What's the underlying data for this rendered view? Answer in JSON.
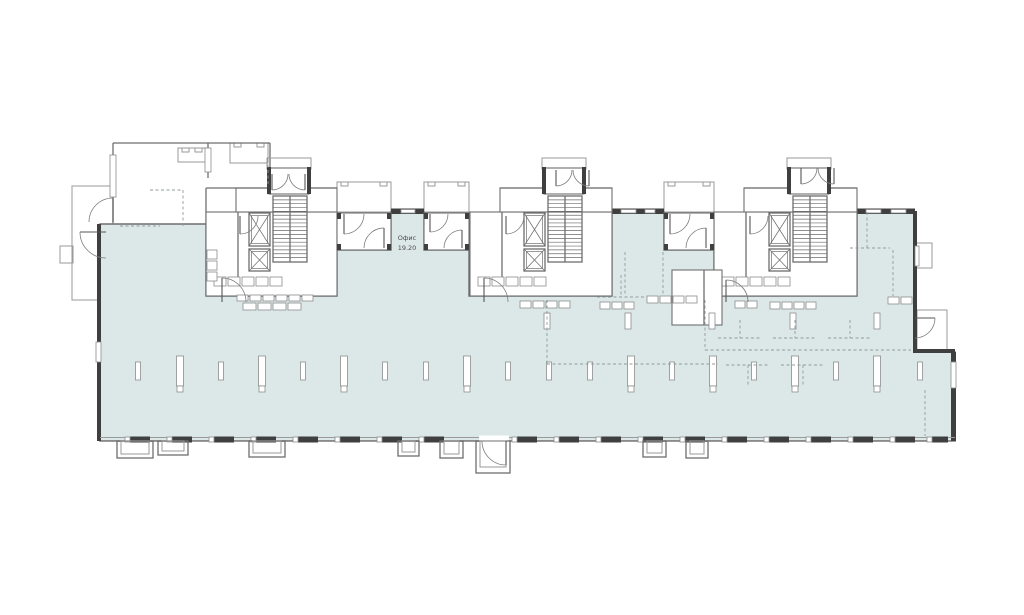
{
  "title": "floor-plan",
  "label": {
    "name": "Офис",
    "area": "19.20"
  },
  "colors": {
    "paper": "#ffffff",
    "space_fill": "#dce8e8",
    "wall_dark": "#3f3f3f",
    "line_medium": "#6e6e6e",
    "line_light": "#9a9a9a",
    "dashed": "#8f9b9b",
    "text": "#4c4c4c"
  },
  "plan": {
    "space_path": "M100,224 H206 V296 H337 V250 H391 V212 H424 V250 H469 V296 H612 V212 H664 V250 H714 V296 H857 V212 H915 V352 H955 V441 H100 Z",
    "label_pos": {
      "x": 407,
      "y1": 240,
      "y2": 250
    },
    "cores": [
      {
        "x": 206,
        "w": 131,
        "fixtures": true
      },
      {
        "x": 470,
        "w": 142,
        "fixtures": false
      },
      {
        "x": 714,
        "w": 143,
        "fixtures": false
      }
    ],
    "vestibules": [
      {
        "x": 337,
        "w": 54
      },
      {
        "x": 424,
        "w": 45
      },
      {
        "x": 664,
        "w": 50
      }
    ],
    "canopies": [
      {
        "x": 337,
        "y": 182,
        "w": 54,
        "h": 30
      },
      {
        "x": 424,
        "y": 182,
        "w": 45,
        "h": 30
      },
      {
        "x": 664,
        "y": 182,
        "w": 50,
        "h": 30
      },
      {
        "x": 230,
        "y": 143,
        "w": 38,
        "h": 20
      },
      {
        "x": 178,
        "y": 148,
        "w": 28,
        "h": 14
      }
    ],
    "exterior_rects": [
      {
        "x": 72,
        "y": 186,
        "w": 41,
        "h": 114
      },
      {
        "x": 60,
        "y": 246,
        "w": 13,
        "h": 17
      },
      {
        "x": 917,
        "y": 310,
        "w": 30,
        "h": 42
      },
      {
        "x": 915,
        "y": 243,
        "w": 17,
        "h": 25
      }
    ],
    "apartment_walls": [
      [
        113,
        143,
        270,
        143
      ],
      [
        113,
        143,
        113,
        223
      ],
      [
        270,
        143,
        270,
        188
      ],
      [
        206,
        188,
        206,
        223
      ],
      [
        206,
        188,
        236,
        188
      ],
      [
        208,
        143,
        208,
        178
      ]
    ],
    "apartment_windows": [
      {
        "x": 110,
        "y": 155,
        "w": 6,
        "h": 42
      },
      {
        "x": 205,
        "y": 148,
        "w": 6,
        "h": 24
      }
    ],
    "dark_walls": [
      {
        "x": 97,
        "y": 224,
        "w": 4,
        "h": 217
      },
      {
        "x": 913,
        "y": 211,
        "w": 4,
        "h": 141
      },
      {
        "x": 951,
        "y": 352,
        "w": 5,
        "h": 89
      },
      {
        "x": 913,
        "y": 349,
        "w": 42,
        "h": 4
      }
    ],
    "wall_window_breaks": [
      {
        "x": 96,
        "y": 342,
        "w": 5,
        "h": 20
      },
      {
        "x": 951,
        "y": 362,
        "w": 5,
        "h": 26
      },
      {
        "x": 915,
        "y": 246,
        "w": 4,
        "h": 20
      }
    ],
    "top_wall_segments": [
      {
        "x1": 391,
        "x2": 424,
        "windows": [
          [
            401,
            14
          ]
        ]
      },
      {
        "x1": 612,
        "x2": 664,
        "windows": [
          [
            621,
            15
          ],
          [
            645,
            10
          ]
        ]
      },
      {
        "x1": 857,
        "x2": 915,
        "windows": [
          [
            866,
            15
          ],
          [
            891,
            15
          ]
        ]
      }
    ],
    "bottom_wall": {
      "x1": 100,
      "x2": 955,
      "y": 437,
      "pier_w": 20,
      "piers": [
        130,
        172,
        214,
        256,
        298,
        340,
        382,
        424,
        517,
        559,
        601,
        643,
        685,
        727,
        769,
        811,
        853,
        895,
        932
      ],
      "door_gap": {
        "x": 479,
        "w": 30
      }
    },
    "wells": [
      {
        "x": 117,
        "w": 36,
        "h": 17
      },
      {
        "x": 158,
        "w": 30,
        "h": 14
      },
      {
        "x": 249,
        "w": 36,
        "h": 16
      },
      {
        "x": 398,
        "w": 21,
        "h": 15
      },
      {
        "x": 440,
        "w": 23,
        "h": 17
      },
      {
        "x": 643,
        "w": 23,
        "h": 16
      },
      {
        "x": 686,
        "w": 22,
        "h": 17
      }
    ],
    "entry_porch": {
      "x": 476,
      "y": 441,
      "w": 34,
      "h": 32
    },
    "columns": [
      {
        "x": 138,
        "t": "s"
      },
      {
        "x": 180,
        "t": "t"
      },
      {
        "x": 221,
        "t": "s"
      },
      {
        "x": 262,
        "t": "t"
      },
      {
        "x": 303,
        "t": "s"
      },
      {
        "x": 344,
        "t": "t"
      },
      {
        "x": 385,
        "t": "s"
      },
      {
        "x": 426,
        "t": "s"
      },
      {
        "x": 467,
        "t": "t"
      },
      {
        "x": 508,
        "t": "s"
      },
      {
        "x": 549,
        "t": "s"
      },
      {
        "x": 590,
        "t": "s"
      },
      {
        "x": 631,
        "t": "t"
      },
      {
        "x": 672,
        "t": "s"
      },
      {
        "x": 713,
        "t": "t"
      },
      {
        "x": 754,
        "t": "s"
      },
      {
        "x": 795,
        "t": "t"
      },
      {
        "x": 836,
        "t": "s"
      },
      {
        "x": 877,
        "t": "t"
      },
      {
        "x": 920,
        "t": "s"
      }
    ],
    "mid_columns": [
      {
        "x": 547
      },
      {
        "x": 628
      },
      {
        "x": 712
      },
      {
        "x": 793
      },
      {
        "x": 877
      }
    ],
    "slab_rows": [
      {
        "x": 237,
        "y": 295,
        "n": 6,
        "w": 11,
        "h": 6,
        "gap": 2
      },
      {
        "x": 243,
        "y": 303,
        "n": 4,
        "w": 13,
        "h": 7,
        "gap": 2
      },
      {
        "x": 520,
        "y": 301,
        "n": 4,
        "w": 11,
        "h": 7,
        "gap": 2
      },
      {
        "x": 600,
        "y": 302,
        "n": 3,
        "w": 10,
        "h": 7,
        "gap": 2
      },
      {
        "x": 647,
        "y": 296,
        "n": 4,
        "w": 11,
        "h": 7,
        "gap": 2
      },
      {
        "x": 735,
        "y": 301,
        "n": 2,
        "w": 10,
        "h": 7,
        "gap": 2
      },
      {
        "x": 770,
        "y": 302,
        "n": 4,
        "w": 10,
        "h": 7,
        "gap": 2
      },
      {
        "x": 888,
        "y": 297,
        "n": 2,
        "w": 11,
        "h": 7,
        "gap": 2
      }
    ],
    "wc_room": {
      "x": 672,
      "y": 270,
      "w": 50,
      "h": 55
    },
    "doors": [
      {
        "x": 344,
        "y": 214,
        "r": 20,
        "dir": "down-right"
      },
      {
        "x": 384,
        "y": 248,
        "r": 20,
        "dir": "up-left"
      },
      {
        "x": 430,
        "y": 214,
        "r": 18,
        "dir": "down-right"
      },
      {
        "x": 462,
        "y": 248,
        "r": 18,
        "dir": "up-left"
      },
      {
        "x": 670,
        "y": 214,
        "r": 20,
        "dir": "down-right"
      },
      {
        "x": 706,
        "y": 248,
        "r": 20,
        "dir": "up-left"
      },
      {
        "x": 272,
        "y": 174,
        "r": 16,
        "dir": "down-right"
      },
      {
        "x": 305,
        "y": 174,
        "r": 16,
        "dir": "down-left"
      },
      {
        "x": 556,
        "y": 170,
        "r": 16,
        "dir": "down-right"
      },
      {
        "x": 589,
        "y": 170,
        "r": 16,
        "dir": "down-left"
      },
      {
        "x": 801,
        "y": 168,
        "r": 16,
        "dir": "down-right"
      },
      {
        "x": 834,
        "y": 168,
        "r": 16,
        "dir": "down-left"
      },
      {
        "x": 240,
        "y": 216,
        "r": 18,
        "dir": "down-right"
      },
      {
        "x": 506,
        "y": 216,
        "r": 18,
        "dir": "down-right"
      },
      {
        "x": 750,
        "y": 216,
        "r": 18,
        "dir": "down-right"
      },
      {
        "x": 222,
        "y": 302,
        "r": 24,
        "dir": "up-right"
      },
      {
        "x": 484,
        "y": 302,
        "r": 24,
        "dir": "up-right"
      },
      {
        "x": 726,
        "y": 302,
        "r": 22,
        "dir": "up-right"
      },
      {
        "x": 106,
        "y": 232,
        "r": 26,
        "dir": "left-down"
      },
      {
        "x": 113,
        "y": 222,
        "r": 24,
        "dir": "up-left"
      },
      {
        "x": 915,
        "y": 318,
        "r": 20,
        "dir": "right-down"
      },
      {
        "x": 506,
        "y": 441,
        "r": 24,
        "dir": "down-left"
      }
    ],
    "dashed_paths": [
      "M183,190 V228",
      "M268,148 V186",
      "M150,190 H183",
      "M120,226 H160",
      "M547,300 V364",
      "M547,364 H718",
      "M597,297 H645",
      "M621,275 V297",
      "M625,252 V296",
      "M663,252 V296",
      "M705,300 V350",
      "M705,350 H911",
      "M718,338 H762",
      "M740,320 V338",
      "M773,338 H817",
      "M795,320 V338",
      "M828,338 H872",
      "M850,320 V338",
      "M726,365 H770",
      "M748,365 V385",
      "M781,365 H825",
      "M803,365 V385",
      "M867,212 V248",
      "M850,248 H890",
      "M893,250 V296",
      "M925,390 V436"
    ]
  }
}
